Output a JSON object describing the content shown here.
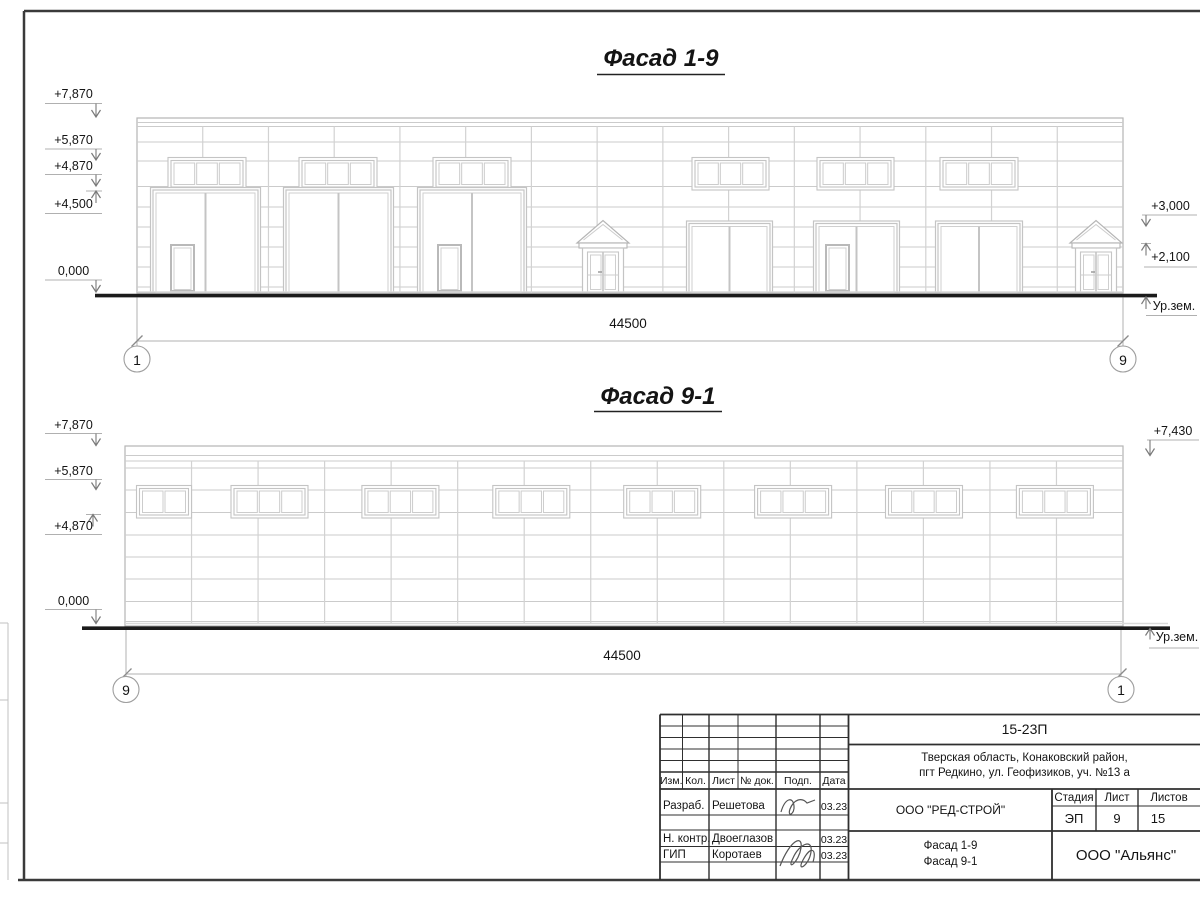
{
  "facades": [
    {
      "title": "Фасад 1-9",
      "axis_left": "1",
      "axis_right": "9",
      "dimension": "44500",
      "elevation_marks_left": [
        "+7,870",
        "+5,870",
        "+4,870",
        "+4,500",
        "0,000"
      ],
      "elevation_marks_right": [
        "+3,000",
        "+2,100"
      ],
      "ground_label": "Ур.зем."
    },
    {
      "title": "Фасад 9-1",
      "axis_left": "9",
      "axis_right": "1",
      "dimension": "44500",
      "elevation_marks_left": [
        "+7,870",
        "+5,870",
        "+4,870",
        "0,000"
      ],
      "elevation_marks_right": [
        "+7,430"
      ],
      "ground_label": "Ур.зем."
    }
  ],
  "title_block": {
    "project_code": "15-23П",
    "address_line1": "Тверская область, Конаковский район,",
    "address_line2": "пгт Редкино, ул. Геофизиков, уч. №13 а",
    "column_headers": [
      "Изм.",
      "Кол.",
      "Лист",
      "№ док.",
      "Подп.",
      "Дата"
    ],
    "rows": [
      {
        "role": "Разраб.",
        "name": "Решетова",
        "date": "03.23"
      },
      {
        "role": "Н. контр.",
        "name": "Двоеглазов",
        "date": "03.23"
      },
      {
        "role": "ГИП",
        "name": "Коротаев",
        "date": "03.23"
      }
    ],
    "designer_company": "ООО \"РЕД-СТРОЙ\"",
    "stage_header": "Стадия",
    "sheet_header": "Лист",
    "sheets_header": "Листов",
    "stage": "ЭП",
    "sheet_number": "9",
    "sheets_total": "15",
    "drawing_title_line1": "Фасад 1-9",
    "drawing_title_line2": "Фасад 9-1",
    "client_company": "ООО \"Альянс\""
  },
  "colors": {
    "line_light": "#cbcbcb",
    "line_grid": "#d2d2d2",
    "line_outline": "#b5b5b5",
    "line_frame_el": "#c4c4c4",
    "line_dim": "#b0b0b0",
    "line_arrow": "#7a7a7a",
    "line_dark": "#1b1b1b",
    "line_block": "#2f2f2f",
    "text": "#141414"
  }
}
